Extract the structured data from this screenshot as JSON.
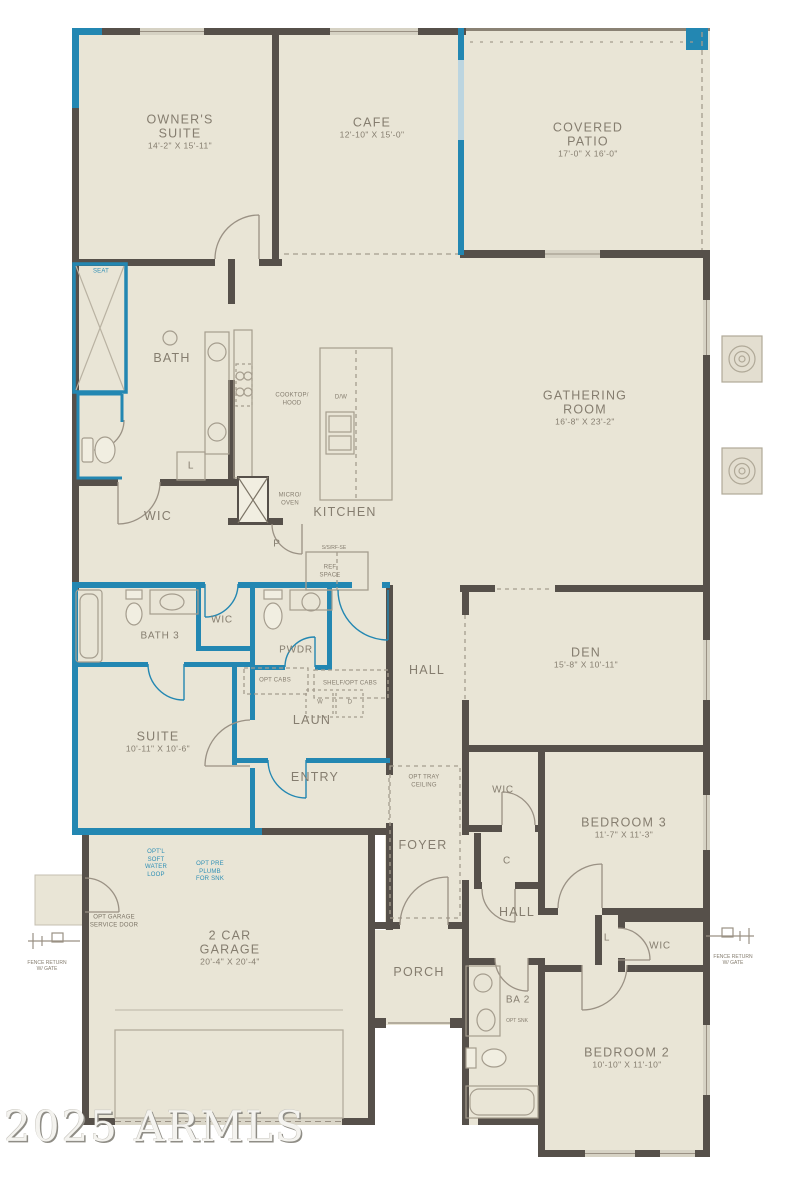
{
  "watermark": "2025 ARMLS",
  "colors": {
    "walls": "#56504a",
    "accent_blue": "#2387b2",
    "floor": "#e9e5d6",
    "label": "#857d6f"
  },
  "rooms": {
    "owners_suite": {
      "name": "OWNER'S SUITE",
      "dims": "14'-2\" X 15'-11\""
    },
    "cafe": {
      "name": "CAFE",
      "dims": "12'-10\" X 15'-0\""
    },
    "covered_patio": {
      "name": "COVERED PATIO",
      "dims": "17'-0\" X 16'-0\""
    },
    "gathering": {
      "name": "GATHERING ROOM",
      "dims": "16'-8\" X 23'-2\""
    },
    "bath": {
      "name": "BATH"
    },
    "wic_owner": {
      "name": "WIC"
    },
    "kitchen": {
      "name": "KITCHEN"
    },
    "bath3": {
      "name": "BATH 3"
    },
    "wic_suite": {
      "name": "WIC"
    },
    "pwdr": {
      "name": "PWDR"
    },
    "suite": {
      "name": "SUITE",
      "dims": "10'-11\" X 10'-6\""
    },
    "laun": {
      "name": "LAUN"
    },
    "entry": {
      "name": "ENTRY"
    },
    "hall_main": {
      "name": "HALL"
    },
    "den": {
      "name": "DEN",
      "dims": "15'-8\" X 10'-11\""
    },
    "foyer": {
      "name": "FOYER"
    },
    "wic_bed3": {
      "name": "WIC"
    },
    "bedroom3": {
      "name": "BEDROOM 3",
      "dims": "11'-7\" X 11'-3\""
    },
    "hall_bed": {
      "name": "HALL"
    },
    "wic_bed2": {
      "name": "WIC"
    },
    "garage": {
      "name": "2 CAR GARAGE",
      "dims": "20'-4\" X 20'-4\""
    },
    "porch": {
      "name": "PORCH"
    },
    "ba2": {
      "name": "BA 2"
    },
    "bedroom2": {
      "name": "BEDROOM 2",
      "dims": "10'-10\" X 11'-10\""
    }
  },
  "annotations": {
    "seat": "SEAT",
    "cooktop_hood": "COOKTOP/ HOOD",
    "dw": "D/W",
    "micro_oven": "MICRO/ OVEN",
    "pantry": "P",
    "ref_note": "S/S/RF-SE",
    "ref_space": "REF SPACE",
    "linen_bath": "L",
    "opt_cabs": "OPT CABS",
    "shelf_opt_cabs": "SHELF/OPT CABS",
    "washer": "W",
    "dryer": "D",
    "opt_tray": "OPT TRAY CEILING",
    "coat": "C",
    "linen_hall": "L",
    "opt_soft_water": "OPT'L SOFT WATER LOOP",
    "opt_preplumb": "OPT PRE PLUMB FOR SNK",
    "opt_garage_door": "OPT GARAGE SERVICE DOOR",
    "opt_snk": "OPT SNK",
    "fence_left": "FENCE RETURN W/ GATE",
    "fence_right": "FENCE RETURN W/ GATE"
  }
}
